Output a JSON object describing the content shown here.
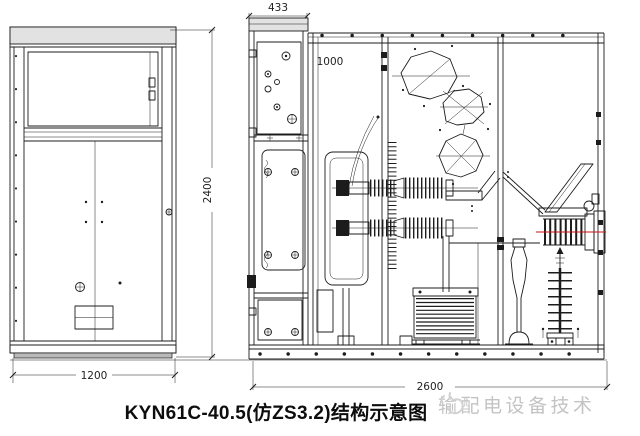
{
  "drawing": {
    "title": "KYN61C-40.5(仿ZS3.2)结构示意图"
  },
  "dimensions": {
    "front_width": "1200",
    "front_height": "2400",
    "column_width": "433",
    "roof_depth": "1000",
    "total_depth": "2600"
  },
  "watermark": {
    "icon": "pointing-hand-icon",
    "text": "输配电设备技术"
  },
  "colors": {
    "line": "#1c1c1c",
    "bushing_centerline_red": "#cc1111",
    "watermark_gray": "#c3c3c3",
    "background": "#ffffff"
  }
}
